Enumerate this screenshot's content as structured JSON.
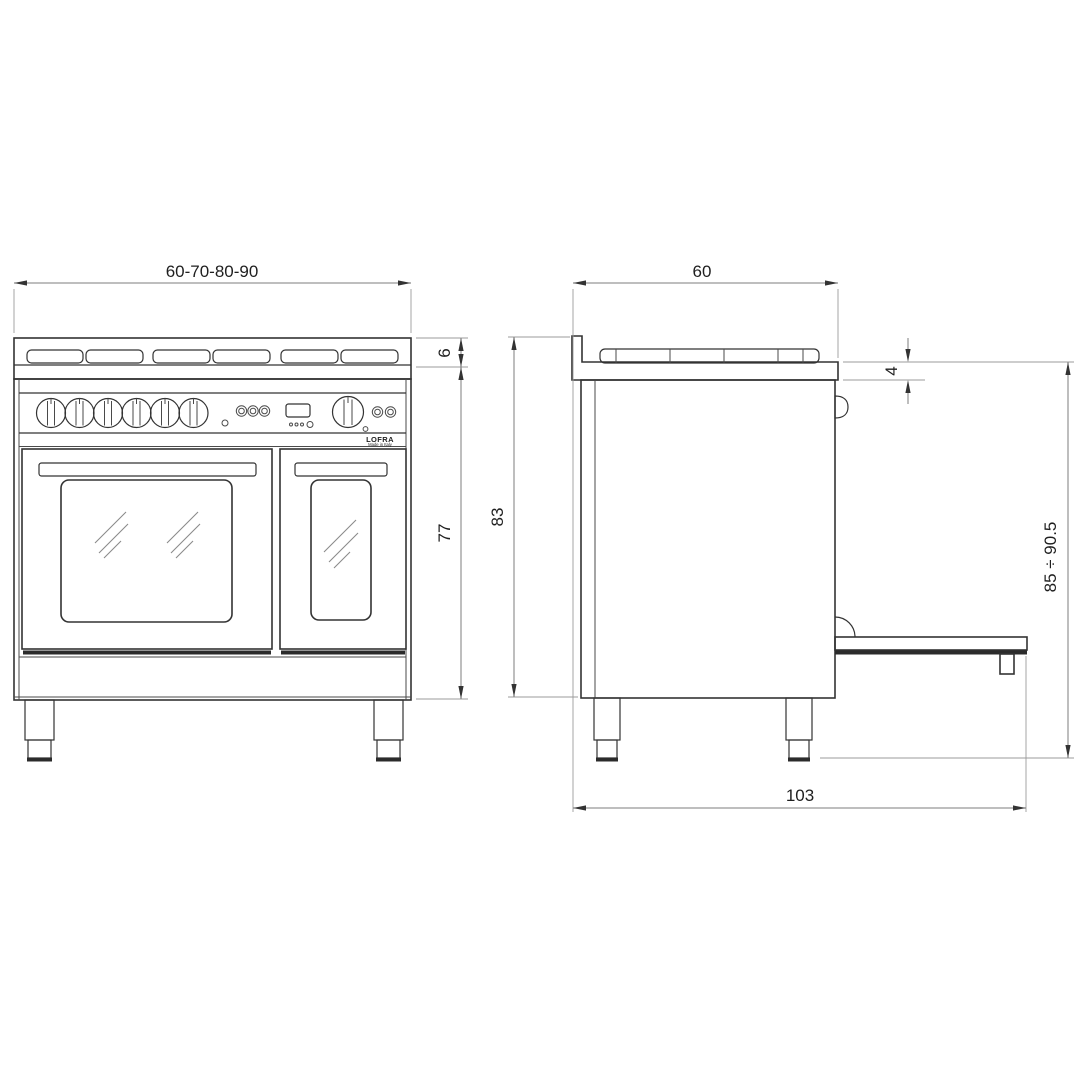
{
  "brand": {
    "name": "LOFRA",
    "tagline": "Made in Italy"
  },
  "dimensions": {
    "front_width": "60-70-80-90",
    "hob_edge_height": "6",
    "body_height": "77",
    "depth": "60",
    "worktop_thickness": "4",
    "overall_height": "83",
    "height_range": "85 ÷ 90.5",
    "depth_door_open": "103"
  },
  "colors": {
    "background": "#ffffff",
    "outline": "#333333",
    "dimension_line": "#7d7d7d",
    "extension_line": "#9b9b9b",
    "text": "#1f1f1f"
  }
}
